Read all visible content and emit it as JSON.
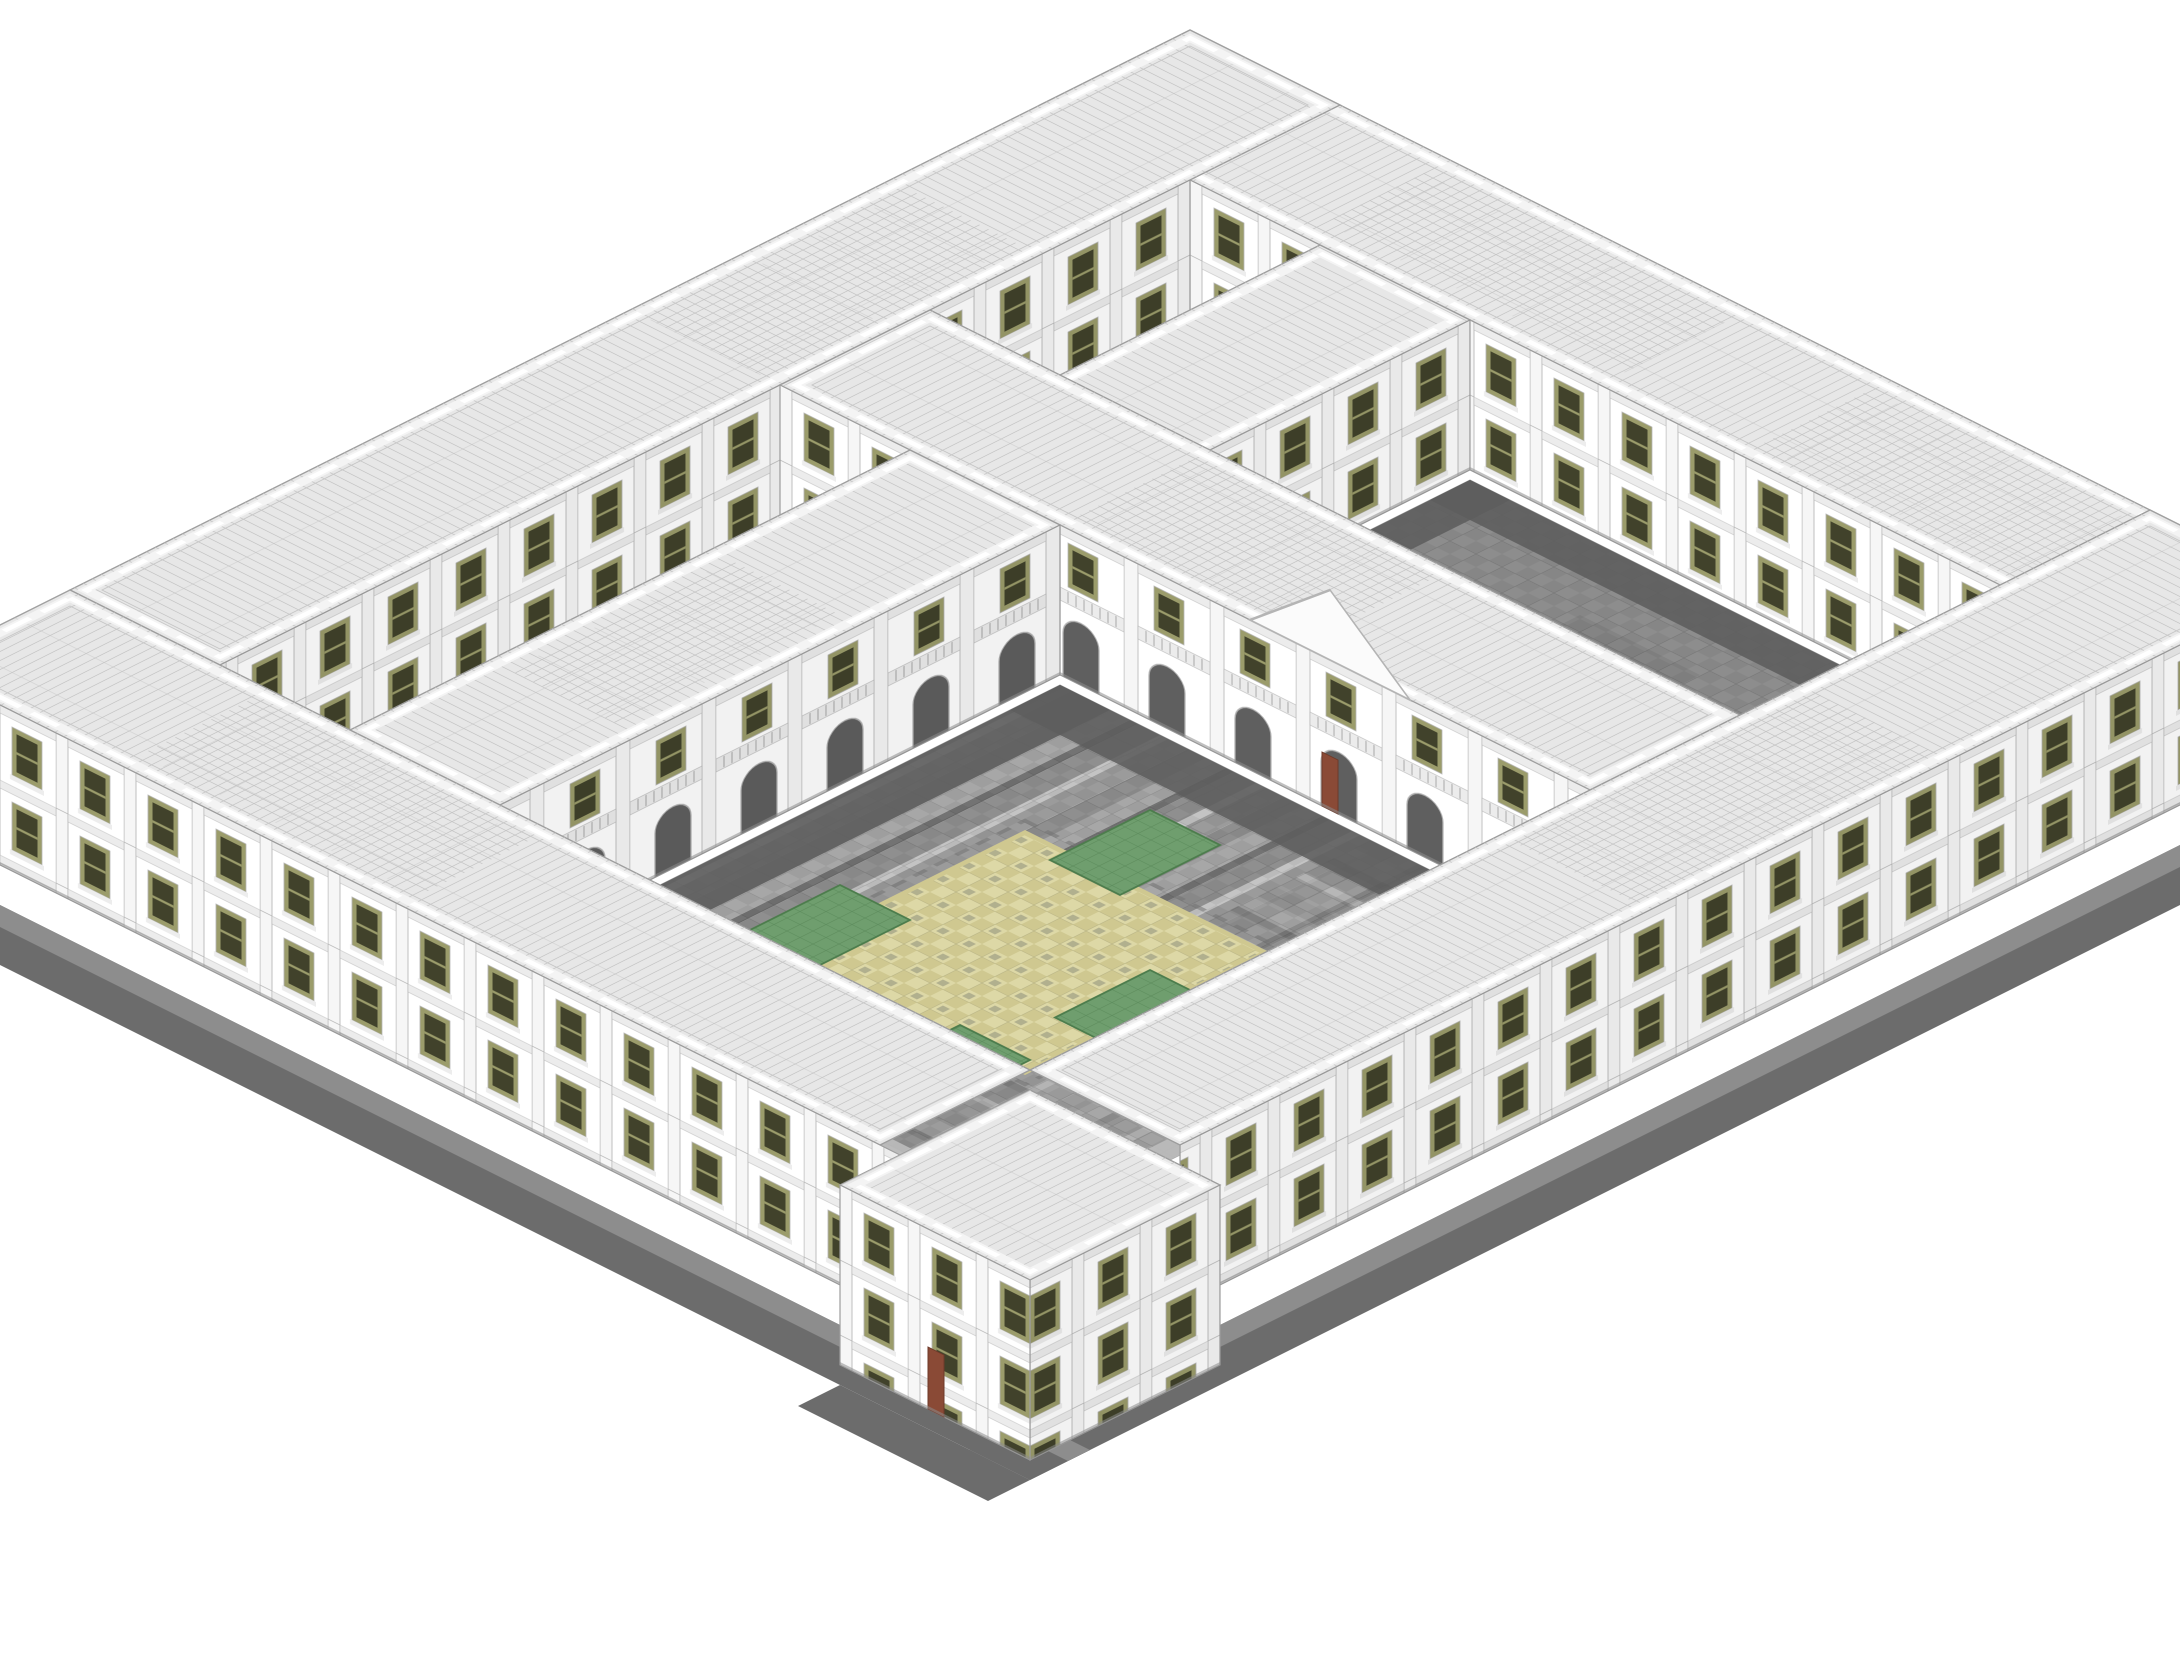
{
  "meta": {
    "render_type": "isometric-voxel-building-render",
    "subject": "palace-complex-with-courtyards",
    "has_text": false
  },
  "colors": {
    "background": "#ffffff",
    "line": "#9c9c9c",
    "roof": "#e7e7e7",
    "roof_line": "#c6c6c6",
    "parapet": "#f4f4f4",
    "wall": "#ffffff",
    "wall_line": "#b4b4b4",
    "pilaster": "#f6f6f6",
    "course": "#ececec",
    "window_frame": "#9b9c6b",
    "window_pane": "#41422b",
    "arch_opening": "#5f5f5f",
    "door": "#8a4a36",
    "court_small": "#8d8d8d",
    "court_shadow": "#5d5d5d",
    "stripe_1": "#a7a7a7",
    "stripe_2": "#8f8f8f",
    "stripe_3": "#c4c4c4",
    "stripe_4": "#737373",
    "mosaic_a": "#ddd8a6",
    "mosaic_b": "#cfc890",
    "mosaic_c": "#a9a98a",
    "lawn": "#6f9e6e",
    "terrace_mid": "#8d8d8d",
    "terrace_dark": "#6c6c6c",
    "border_light": "#bcbcbc"
  },
  "scene": {
    "outer_wings": 4,
    "cross_wings": 2,
    "courtyards": 4,
    "main_courtyard": {
      "paving": "diagonal-gray-stripes",
      "mosaic": "tan-checker-diamond",
      "lawns": 4,
      "arcade_sides": 2
    },
    "small_courtyard_lawns": 1,
    "facade": {
      "window_rows": 2,
      "glazing": "olive",
      "style": "white-stone-pilasters"
    }
  }
}
